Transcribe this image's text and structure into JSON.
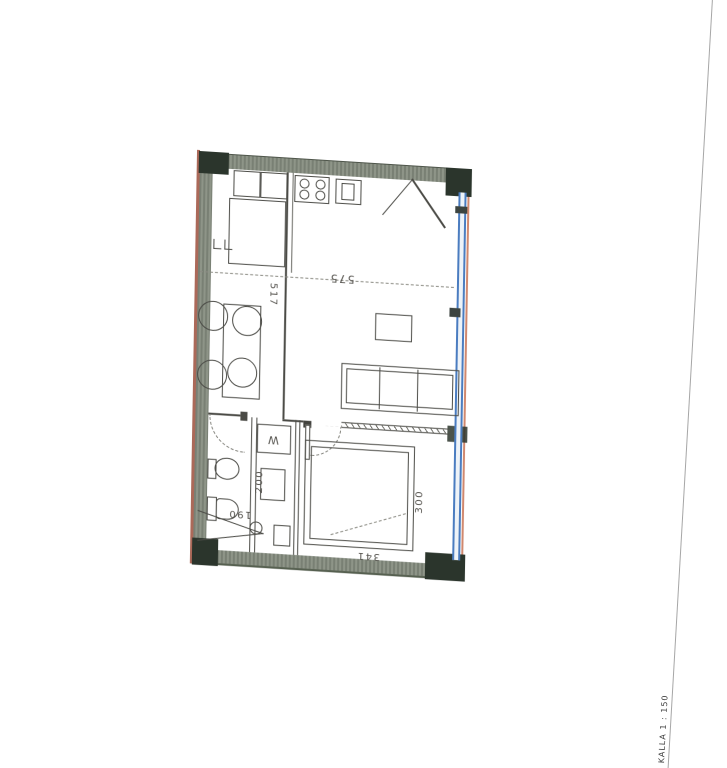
{
  "page": {
    "scale_note": "KALLA  1 : 150"
  },
  "floor_plan": {
    "dimensions": {
      "living_width": "575",
      "dining_depth": "517",
      "bathroom_width": "190",
      "hall_length": "200",
      "bedroom_depth": "300",
      "bedroom_width": "341"
    },
    "appliances": {
      "washing_machine_label": "W"
    }
  },
  "colors": {
    "paper": "#ffffff",
    "wall": "#878e81",
    "column": "#2b352c",
    "window-blue": "#4a7cc0",
    "boundary-red": "#9c4f3c",
    "boundary-orange": "#c46a4a",
    "line": "#4b4b46"
  }
}
